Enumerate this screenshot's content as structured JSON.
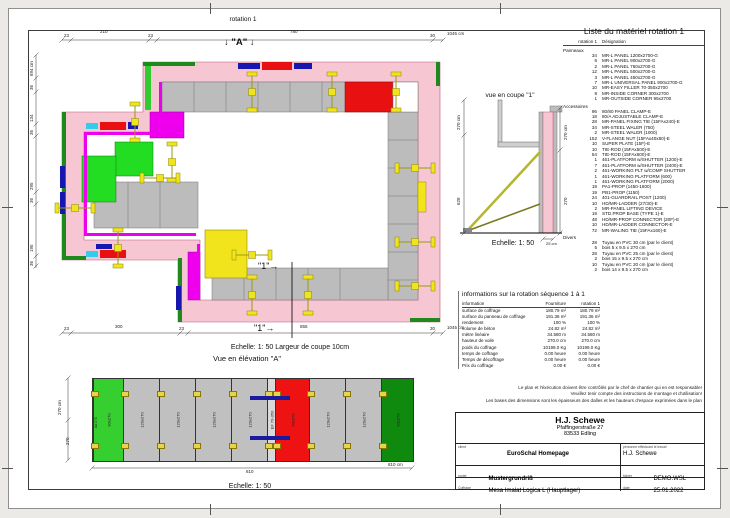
{
  "page": {
    "sheet_title": "rotation 1"
  },
  "icons": {
    "arrow_down": "↓",
    "arrow_right": "→"
  },
  "plan": {
    "title": "rotation 1",
    "elevation_marker": "\"A\"",
    "section_marker": "\"1\"",
    "scale_note": "Echelle: 1: 50   Largeur de coupe 10cm",
    "dims": {
      "top": [
        "23",
        "210",
        "23",
        "780",
        "30",
        "1045 cm"
      ],
      "bottom": [
        "23",
        "300",
        "23",
        "855",
        "30",
        "1045 cm"
      ],
      "left": [
        "694 cm",
        "36",
        "134",
        "36",
        "295",
        "36",
        "195",
        "36"
      ]
    }
  },
  "section": {
    "title": "vue en coupe \"1\"",
    "scale": "Echelle: 1: 50",
    "dims": {
      "left": [
        "270 cm",
        "628"
      ],
      "right": [
        "270 cm",
        "270"
      ],
      "bottom": "25 cm"
    }
  },
  "elevation": {
    "title": "Vue en élévation \"A\"",
    "scale": "Echelle: 1: 50",
    "dims": {
      "left": [
        "270 cm",
        "270"
      ],
      "edge": "Ad 270",
      "bottom_total": "810",
      "bottom_unit": "810 cm"
    },
    "panels": [
      {
        "label": "90x270",
        "color": "#35d02f",
        "w": 30
      },
      {
        "label": "120x270",
        "color": "#c0c0c0",
        "w": 36
      },
      {
        "label": "120x270",
        "color": "#c0c0c0",
        "w": 36
      },
      {
        "label": "120x270",
        "color": "#c0c0c0",
        "w": 36
      },
      {
        "label": "120x270",
        "color": "#c0c0c0",
        "w": 36
      },
      {
        "label": "EF 70-350",
        "color": "#d9d9d9",
        "w": 8
      },
      {
        "label": "90x270",
        "color": "#ee1212",
        "w": 34
      },
      {
        "label": "120x270",
        "color": "#c0c0c0",
        "w": 36
      },
      {
        "label": "120x270",
        "color": "#c0c0c0",
        "w": 36
      },
      {
        "label": "90x270",
        "color": "#0f8a0f",
        "w": 32
      }
    ]
  },
  "materials": {
    "title": "Liste du matériel  rotation 1",
    "col_qty": "rotation 1",
    "col_des": "Désignation",
    "sec1": {
      "title": "Panneaux",
      "rows": [
        {
          "q": "34",
          "d": "MR-L PANEL 1200x2700-G"
        },
        {
          "q": "6",
          "d": "MR-L PANEL 900x2700-G"
        },
        {
          "q": "2",
          "d": "MR-L PANEL 750x2700-G"
        },
        {
          "q": "12",
          "d": "MR-L PANEL 500x2700-G"
        },
        {
          "q": "3",
          "d": "MR-L PANEL 450x2700-G"
        },
        {
          "q": "7",
          "d": "MR-L UNIVERSAL PANEL 900x2700-G"
        },
        {
          "q": "10",
          "d": "MR-EASY FILLER 70-350x2700"
        },
        {
          "q": "8",
          "d": "MR-INSIDE CORNER 300x2700"
        },
        {
          "q": "1",
          "d": "MR-OUTSIDE CORNER 95x2700"
        }
      ]
    },
    "sec2": {
      "title": "Accessoires",
      "rows": [
        {
          "q": "96",
          "d": "80/80 PANEL CLAMP-E"
        },
        {
          "q": "18",
          "d": "80/A ADJUSTABLE CLAMP-E"
        },
        {
          "q": "28",
          "d": "MR-PANEL FIXING TIE (15FAx240)-E"
        },
        {
          "q": "34",
          "d": "MR-STEEL WALER (750)"
        },
        {
          "q": "2",
          "d": "MR-STEEL WALER (1000)"
        },
        {
          "q": "152",
          "d": "V-FLANGE NUT (15FAx40x80)-E"
        },
        {
          "q": "10",
          "d": "SUPER PLATE (15F)-E"
        },
        {
          "q": "10",
          "d": "TIE-ROD (15FAx500)-E"
        },
        {
          "q": "54",
          "d": "TIE-ROD (15FAx600)-E"
        },
        {
          "q": "1",
          "d": "461-PLATFORM w/SHUTTER (1200)-E"
        },
        {
          "q": "7",
          "d": "461-PLATFORM w/SHUTTER (2400)-E"
        },
        {
          "q": "2",
          "d": "461-WORKING PLT w/COMP SHUTTER"
        },
        {
          "q": "1",
          "d": "461-WORKING PLATFORM (600)"
        },
        {
          "q": "1",
          "d": "461-WORKING PLATFORM (2000)"
        },
        {
          "q": "19",
          "d": "PA1-PROP (1450-1800)"
        },
        {
          "q": "19",
          "d": "PB1-PROP (1150)"
        },
        {
          "q": "24",
          "d": "401-GUARDRAIL POST (1200)"
        },
        {
          "q": "10",
          "d": "HD/MR-LADDER (27/30)-E"
        },
        {
          "q": "2",
          "d": "MR-PANEL LIFTING DEVICE"
        },
        {
          "q": "19",
          "d": "STD.PROP BASE (TYPE 1)-E"
        },
        {
          "q": "48",
          "d": "HD/MR-PROP CONNECTOR (20F)-E"
        },
        {
          "q": "10",
          "d": "HD/MR-LADDER CONNECTOR-E"
        },
        {
          "q": "72",
          "d": "MR-WALING TIE (15FAx160)-E"
        }
      ]
    },
    "sec3": {
      "title": "Divers",
      "rows": [
        {
          "q": "28",
          "d": "Tuyau en PVC 30 cm (par le client)"
        },
        {
          "q": "5",
          "d": "bois 5 x 9.5 x 270 cm"
        },
        {
          "q": "28",
          "d": "Tuyau en PVC 25 cm (par le client)"
        },
        {
          "q": "2",
          "d": "bois 15 x 9.5 x 270 cm"
        },
        {
          "q": "10",
          "d": "Tuyau en PVC 20 cm (par le client)"
        },
        {
          "q": "2",
          "d": "bois 14 x 9.5 x 270 cm"
        }
      ]
    }
  },
  "info": {
    "title": "informations sur la rotation  séquence 1 à 1",
    "col_info": "information",
    "col_a": "Fourniture",
    "col_b": "rotation 1",
    "rows": [
      {
        "label": "surface de coffrage",
        "a": "180.79 m²",
        "b": "180.79 m²"
      },
      {
        "label": "surface du panneau de coffrage",
        "a": "191.36 m²",
        "b": "191.36 m²"
      },
      {
        "label": "rendement",
        "a": "100 %",
        "b": "100 %"
      },
      {
        "label": "volume de béton",
        "a": "24.82 m³",
        "b": "24.82 m³"
      },
      {
        "label": "mètre linéaire",
        "a": "34.580 m",
        "b": "34.580 m"
      },
      {
        "label": "hauteur de voile",
        "a": "270.0 cm",
        "b": "270.0 cm"
      },
      {
        "label": "poids du coffrage",
        "a": "10199.0 Kg",
        "b": "10199.0 Kg"
      },
      {
        "label": "temps de coffrage",
        "a": "0.00 heure",
        "b": "0.00 heure"
      },
      {
        "label": "Temps de décoffrage",
        "a": "0.00 heure",
        "b": "0.00 heure"
      },
      {
        "label": "Prix du coffrage",
        "a": "0.00 €",
        "b": "0.00 €"
      }
    ]
  },
  "disclaimer": {
    "lines": [
      "Le plan et l'éxécution doivent être contrôlés par le chef de chantier qui en est responsable!",
      "Veuillez tenir compte des instructions de montage et d'utilisation!",
      "Les bases des dimensions sont les épaisseurs des dalles et les hauteurs d'espace exprimées dans le plan"
    ]
  },
  "titleblock": {
    "company_name": "H.J. Schewe",
    "address_line1": "Pfaffingerstraße 27",
    "address_line2": "83533 Edling",
    "label_client": "client",
    "client": "EuroSchal Homepage",
    "label_worker": "personne effectuant le travail",
    "worker": "H.J. Schewe",
    "label_project": "projet",
    "project": "Mustergrundriß",
    "label_file": "fichier",
    "file": "DEMO.WSL",
    "label_formwork": "Coffrage",
    "formwork": "Mesa Imalat Logica L (Hauptlager)",
    "label_date": "date",
    "date": "25.01.2022"
  }
}
